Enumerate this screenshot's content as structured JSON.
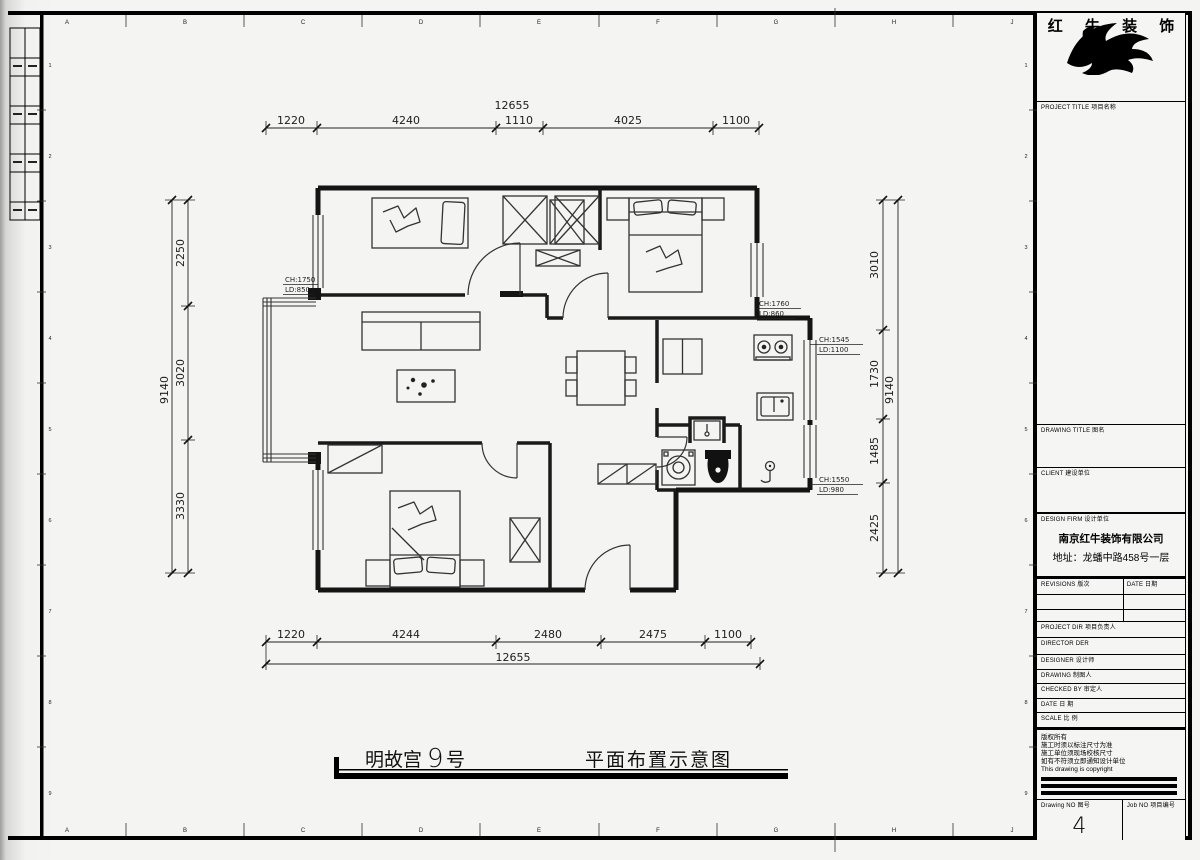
{
  "sheet": {
    "grid_letters": [
      "A",
      "B",
      "C",
      "D",
      "E",
      "F",
      "G",
      "H",
      "J",
      "K"
    ],
    "grid_numbers": [
      "1",
      "2",
      "3",
      "4",
      "5",
      "6",
      "7",
      "8",
      "9"
    ]
  },
  "brand": {
    "name": "红 牛 装 饰"
  },
  "title_block": {
    "project_title": "PROJECT TITLE  项目名称",
    "drawing_title": "DRAWING TITLE  图名",
    "client": "CLIENT  建设单位",
    "design_firm": "DESIGN FIRM  设计单位",
    "firm_name": "南京红牛装饰有限公司",
    "firm_address": "地址：龙蟠中路458号一层",
    "revisions": "REVISIONS  版次",
    "date_col": "DATE  日期",
    "project_dir": "PROJECT DIR  项目负责人",
    "director": "DIRECTOR DER",
    "designer": "DESIGNER  设计师",
    "drawing": "DRAWING  制图人",
    "checked_by": "CHECKED BY  审定人",
    "date_row": "DATE  日 期",
    "scale_row": "SCALE  比 例",
    "notes": [
      "版权所有",
      "施工时须以标注尺寸为准",
      "施工单位须现场校核尺寸",
      "如有不符须立即通知设计单位",
      "This drawing is copyright"
    ],
    "drawing_no_label": "Drawing NO  图号",
    "drawing_no": "4",
    "job_no_label": "Job NO  项目编号"
  },
  "dimensions": {
    "top": {
      "overall": "12655",
      "segments": [
        "1220",
        "4240",
        "1110",
        "4025",
        "1100"
      ]
    },
    "bottom": {
      "overall": "12655",
      "segments": [
        "1220",
        "4244",
        "2480",
        "2475",
        "1100"
      ]
    },
    "left": {
      "overall": "9140",
      "segments": [
        "2250",
        "3020",
        "3330"
      ]
    },
    "right": {
      "overall": "9140",
      "segments": [
        "3010",
        "1730",
        "1485",
        "2425"
      ]
    }
  },
  "annotations": {
    "win_left": {
      "l1": "CH:1750",
      "l2": "LD:850"
    },
    "win_right_top": {
      "l1": "CH:1760",
      "l2": "LD:860"
    },
    "win_right_mid": {
      "l1": "CH:1545",
      "l2": "LD:1100"
    },
    "win_right_bot": {
      "l1": "CH:1550",
      "l2": "LD:980"
    }
  },
  "footer": {
    "address_prefix": "明故宫",
    "address_number": "9",
    "address_suffix": "号",
    "plan_title": "平面布置示意图"
  }
}
